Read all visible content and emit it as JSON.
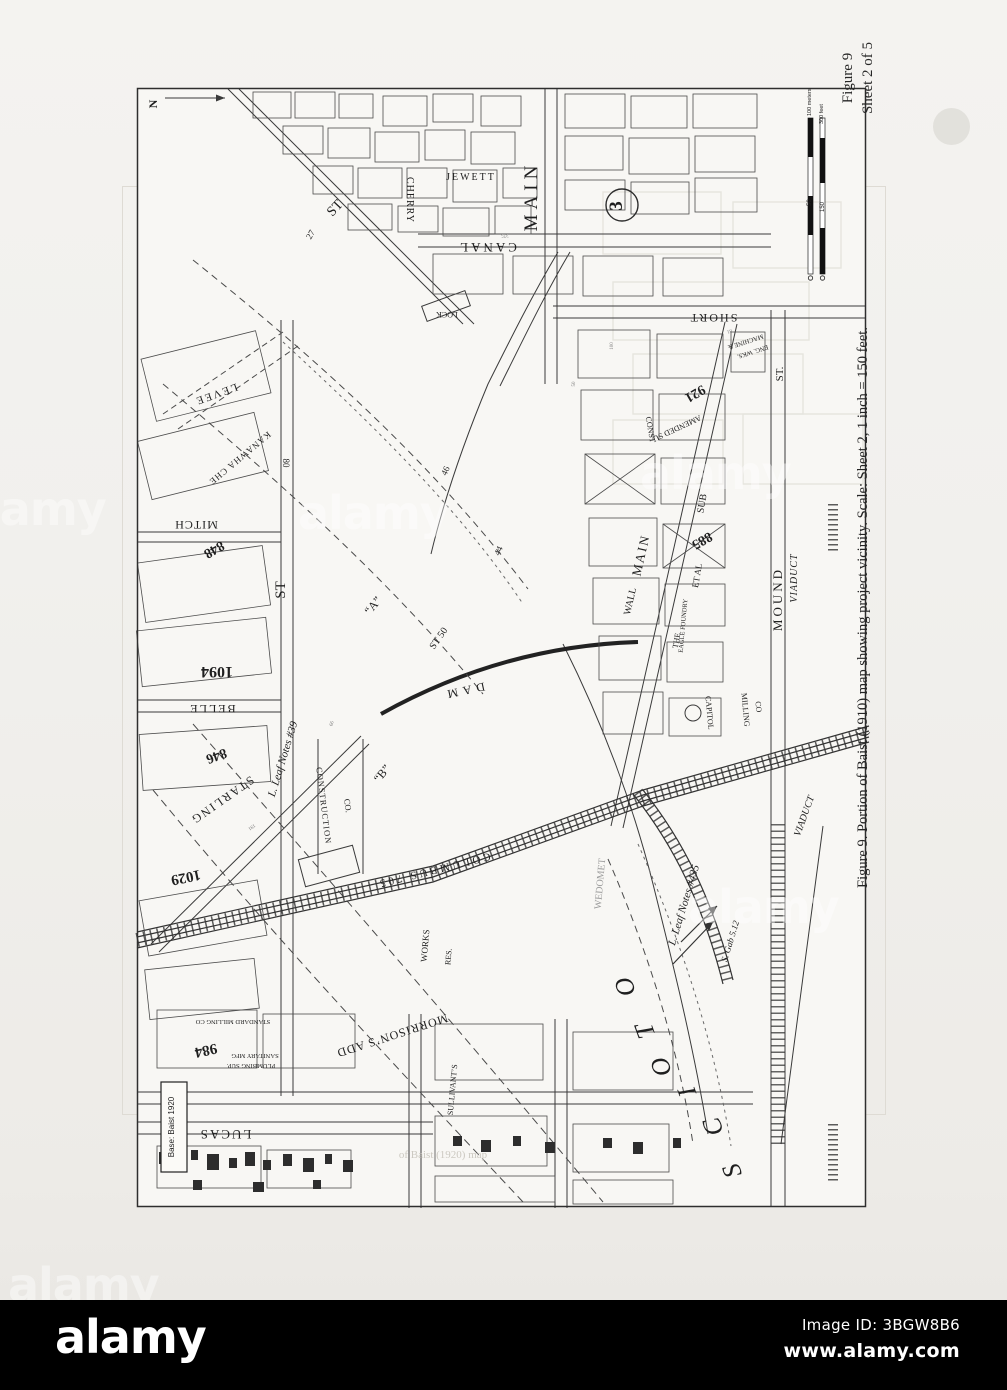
{
  "header": {
    "figure_line1": "Figure 9",
    "figure_line2": "Sheet 2 of 5"
  },
  "caption": "Figure 9.  Portion of Baist (1910) map showing project vicinity.  Scale: Sheet 2, 1 inch = 150 feet.",
  "footer": {
    "brand": "alamy",
    "image_id": "Image ID: 3BGW8B6",
    "url": "www.alamy.com"
  },
  "watermark": {
    "tile": "alamy"
  },
  "map": {
    "labels": [
      {
        "n": "north-label",
        "t": "N",
        "x": 24,
        "y": 20,
        "r": -90,
        "s": 12,
        "w": 1
      },
      {
        "n": "street-st-diagonal",
        "t": "ST",
        "x": 205,
        "y": 127,
        "r": -47,
        "s": 14
      },
      {
        "n": "street-cherry",
        "t": "CHERRY",
        "x": 274,
        "y": 116,
        "r": 90,
        "s": 10,
        "ls": 1
      },
      {
        "n": "street-jewett",
        "t": "JEWETT",
        "x": 338,
        "y": 96,
        "r": 0,
        "s": 10,
        "ls": 2
      },
      {
        "n": "street-main-north",
        "t": "MAIN",
        "x": 404,
        "y": 112,
        "r": -90,
        "s": 19,
        "ls": 5
      },
      {
        "n": "street-canal",
        "t": "CANAL",
        "x": 354,
        "y": 159,
        "r": 180,
        "s": 13,
        "ls": 3
      },
      {
        "n": "lock-label",
        "t": "LOCK",
        "x": 314,
        "y": 228,
        "r": 180,
        "s": 8
      },
      {
        "n": "contour-27",
        "t": "27",
        "x": 180,
        "y": 152,
        "r": -60,
        "s": 9
      },
      {
        "n": "street-short",
        "t": "SHORT",
        "x": 580,
        "y": 230,
        "r": 180,
        "s": 12,
        "ls": 2
      },
      {
        "n": "street-st-right",
        "t": "ST.",
        "x": 650,
        "y": 290,
        "r": -90,
        "s": 11
      },
      {
        "n": "street-mound",
        "t": "MOUND",
        "x": 649,
        "y": 515,
        "r": -90,
        "s": 13,
        "ls": 3
      },
      {
        "n": "mound-viaduct",
        "t": "VIADUCT",
        "x": 664,
        "y": 494,
        "r": -90,
        "s": 10,
        "i": 1,
        "ls": 1
      },
      {
        "n": "machine-works-1",
        "t": "MACHINE &",
        "x": 612,
        "y": 256,
        "r": 162,
        "s": 6.5
      },
      {
        "n": "machine-works-2",
        "t": "ENG. WKS.",
        "x": 619,
        "y": 266,
        "r": 162,
        "s": 6.5
      },
      {
        "n": "plot-921",
        "t": "921",
        "x": 560,
        "y": 306,
        "r": 150,
        "s": 14,
        "w": 1
      },
      {
        "n": "amended-sub",
        "t": "AMENDED SU",
        "x": 543,
        "y": 342,
        "r": 155,
        "s": 8
      },
      {
        "n": "const-label",
        "t": "CONST",
        "x": 515,
        "y": 346,
        "r": 80,
        "s": 8
      },
      {
        "n": "sub-label",
        "t": "SUB",
        "x": 572,
        "y": 420,
        "r": -80,
        "s": 10
      },
      {
        "n": "plot-885",
        "t": "885",
        "x": 567,
        "y": 453,
        "r": 150,
        "s": 14,
        "w": 1
      },
      {
        "n": "et-al",
        "t": "ET AL",
        "x": 567,
        "y": 492,
        "r": -80,
        "s": 9
      },
      {
        "n": "eagle-foundry",
        "t": "EAGLE FOUNDRY",
        "x": 552,
        "y": 542,
        "r": -85,
        "s": 6.5
      },
      {
        "n": "street-main-south",
        "t": "MAIN",
        "x": 512,
        "y": 472,
        "r": -77,
        "s": 13,
        "ls": 2
      },
      {
        "n": "street-wall",
        "t": "WALL",
        "x": 500,
        "y": 518,
        "r": -77,
        "s": 10
      },
      {
        "n": "the-label",
        "t": "THE",
        "x": 546,
        "y": 557,
        "r": -80,
        "s": 8
      },
      {
        "n": "capitol-label",
        "t": "CAPITOL",
        "x": 574,
        "y": 629,
        "r": 85,
        "s": 8
      },
      {
        "n": "milling-label",
        "t": "MILLING",
        "x": 610,
        "y": 626,
        "r": 85,
        "s": 8
      },
      {
        "n": "co-label",
        "t": "CO",
        "x": 623,
        "y": 623,
        "r": 85,
        "s": 8
      },
      {
        "n": "dam-label",
        "t": "DAM",
        "x": 330,
        "y": 603,
        "r": 168,
        "s": 12,
        "ls": 5
      },
      {
        "n": "st50-label",
        "t": "ST 50",
        "x": 308,
        "y": 556,
        "r": -55,
        "s": 10
      },
      {
        "n": "area-a",
        "t": "“A”",
        "x": 243,
        "y": 524,
        "r": -50,
        "s": 12
      },
      {
        "n": "area-b",
        "t": "“B”",
        "x": 252,
        "y": 692,
        "r": -50,
        "s": 12
      },
      {
        "n": "contour-46",
        "t": "46",
        "x": 315,
        "y": 388,
        "r": -65,
        "s": 9
      },
      {
        "n": "contour-44",
        "t": "44",
        "x": 368,
        "y": 468,
        "r": -65,
        "s": 9
      },
      {
        "n": "leaf-notes-39",
        "t": "L. Leaf Notes #39",
        "x": 153,
        "y": 676,
        "r": -73,
        "s": 11,
        "i": 1
      },
      {
        "n": "construction-label",
        "t": "CONSTRUCTION",
        "x": 188,
        "y": 722,
        "r": 83,
        "s": 8.5,
        "ls": 1
      },
      {
        "n": "construction-co",
        "t": "CO.",
        "x": 212,
        "y": 722,
        "r": 83,
        "s": 8.5
      },
      {
        "n": "street-starling",
        "t": "STARLING",
        "x": 87,
        "y": 713,
        "r": 145,
        "s": 12,
        "ls": 2
      },
      {
        "n": "plot-848",
        "t": "848",
        "x": 79,
        "y": 462,
        "r": 150,
        "s": 14,
        "w": 1
      },
      {
        "n": "street-mitch",
        "t": "MITCH",
        "x": 63,
        "y": 437,
        "r": 180,
        "s": 12,
        "ls": 1
      },
      {
        "n": "kanawha-label",
        "t": "KANAWHA CHE",
        "x": 105,
        "y": 372,
        "r": 140,
        "s": 9,
        "ls": 1
      },
      {
        "n": "levee-label",
        "t": "LEVEE",
        "x": 82,
        "y": 307,
        "r": 160,
        "s": 11,
        "ls": 2
      },
      {
        "n": "num-80",
        "t": "80",
        "x": 150,
        "y": 379,
        "r": 90,
        "s": 9
      },
      {
        "n": "street-st-left",
        "t": "ST",
        "x": 152,
        "y": 506,
        "r": -90,
        "s": 15
      },
      {
        "n": "plot-1094",
        "t": "1094",
        "x": 84,
        "y": 583,
        "r": 180,
        "s": 16,
        "w": 1
      },
      {
        "n": "street-belle",
        "t": "BELLE",
        "x": 79,
        "y": 621,
        "r": 180,
        "s": 12,
        "ls": 2
      },
      {
        "n": "plot-846",
        "t": "846",
        "x": 82,
        "y": 668,
        "r": 160,
        "s": 14,
        "w": 1
      },
      {
        "n": "plot-1029",
        "t": "1029",
        "x": 52,
        "y": 789,
        "r": 168,
        "s": 15,
        "w": 1
      },
      {
        "n": "plot-984",
        "t": "984",
        "x": 72,
        "y": 962,
        "r": 168,
        "s": 15,
        "w": 1
      },
      {
        "n": "sanitary-mfg",
        "t": "SANITARY MFG",
        "x": 122,
        "y": 970,
        "r": 180,
        "s": 6.5
      },
      {
        "n": "plumbing-sup",
        "t": "PLUMBING SUP.",
        "x": 118,
        "y": 980,
        "r": 180,
        "s": 6.5
      },
      {
        "n": "standard-milling",
        "t": "STANDARD MILLING CO",
        "x": 100,
        "y": 936,
        "r": 180,
        "s": 6.5
      },
      {
        "n": "street-lucas",
        "t": "LUCAS",
        "x": 92,
        "y": 1046,
        "r": 180,
        "s": 13,
        "ls": 2
      },
      {
        "n": "morrisons-add",
        "t": "MORRISON’S ADD",
        "x": 258,
        "y": 948,
        "r": 162,
        "s": 12,
        "ls": 1
      },
      {
        "n": "sullivants-label",
        "t": "SULLIVANT’S",
        "x": 322,
        "y": 1006,
        "r": -85,
        "s": 8
      },
      {
        "n": "works-label",
        "t": "WORKS",
        "x": 295,
        "y": 862,
        "r": -85,
        "s": 9
      },
      {
        "n": "res-label",
        "t": "RES.",
        "x": 318,
        "y": 873,
        "r": -85,
        "s": 8
      },
      {
        "n": "columbus-705",
        "t": "COLUMBUS 705",
        "x": 300,
        "y": 783,
        "r": 166,
        "s": 11,
        "ls": 3
      },
      {
        "n": "wedomet-label",
        "t": "WEDOMET",
        "x": 470,
        "y": 800,
        "r": -85,
        "s": 10,
        "c": "#9d9d9d"
      },
      {
        "n": "leaf-notes-435",
        "t": "L. Leaf Notes #435",
        "x": 554,
        "y": 822,
        "r": -73,
        "s": 11,
        "i": 1
      },
      {
        "n": "s-gab-512",
        "t": "S. Gab 5.12",
        "x": 600,
        "y": 858,
        "r": -73,
        "s": 9,
        "i": 1
      },
      {
        "n": "scioto-letter-1",
        "t": "S",
        "x": 607,
        "y": 1084,
        "r": -110,
        "s": 26,
        "i": 1
      },
      {
        "n": "scioto-letter-2",
        "t": "C",
        "x": 588,
        "y": 1040,
        "r": -110,
        "s": 26,
        "i": 1
      },
      {
        "n": "scioto-letter-3",
        "t": "I",
        "x": 562,
        "y": 1005,
        "r": -110,
        "s": 26,
        "i": 1
      },
      {
        "n": "scioto-letter-4",
        "t": "O",
        "x": 536,
        "y": 980,
        "r": -110,
        "s": 26,
        "i": 1
      },
      {
        "n": "scioto-letter-5",
        "t": "T",
        "x": 520,
        "y": 944,
        "r": -110,
        "s": 26,
        "i": 1
      },
      {
        "n": "scioto-letter-6",
        "t": "O",
        "x": 500,
        "y": 900,
        "r": -110,
        "s": 26,
        "i": 1
      },
      {
        "n": "viaduct-south",
        "t": "VIADUCT",
        "x": 674,
        "y": 733,
        "r": -70,
        "s": 10,
        "i": 1
      },
      {
        "n": "marker-3",
        "t": "3",
        "x": 489,
        "y": 122,
        "r": -90,
        "s": 19,
        "w": 1
      },
      {
        "n": "base-note",
        "t": "Base: Baist 1920",
        "x": 41,
        "y": 1043,
        "r": -90,
        "s": 8,
        "f": "sans"
      },
      {
        "n": "scale-meters",
        "t": "100 meters",
        "x": 678,
        "y": 32,
        "r": -90,
        "s": 5.5,
        "a": "start",
        "f": "sans"
      },
      {
        "n": "scale-feet",
        "t": "300 feet",
        "x": 690,
        "y": 40,
        "r": -90,
        "s": 5.5,
        "a": "start",
        "f": "sans"
      },
      {
        "n": "scale-50",
        "t": "50",
        "x": 678,
        "y": 122,
        "r": -90,
        "s": 6,
        "a": "start",
        "f": "sans"
      },
      {
        "n": "scale-150",
        "t": "150",
        "x": 691,
        "y": 128,
        "r": -90,
        "s": 6,
        "a": "start",
        "f": "sans"
      },
      {
        "n": "lot-375",
        "t": "375",
        "x": 372,
        "y": 150,
        "r": 180,
        "s": 5,
        "c": "#777777"
      },
      {
        "n": "lot-100",
        "t": "100",
        "x": 480,
        "y": 262,
        "r": -90,
        "s": 5,
        "c": "#777777"
      },
      {
        "n": "lot-50",
        "t": "50",
        "x": 442,
        "y": 300,
        "r": -90,
        "s": 5,
        "c": "#777777"
      },
      {
        "n": "lot-81",
        "t": "81",
        "x": 596,
        "y": 246,
        "r": 160,
        "s": 5,
        "c": "#777777"
      },
      {
        "n": "lot-191",
        "t": "191",
        "x": 118,
        "y": 742,
        "r": 145,
        "s": 5,
        "c": "#777777"
      },
      {
        "n": "lot-66",
        "t": "66",
        "x": 200,
        "y": 640,
        "r": -73,
        "s": 5,
        "c": "#777777"
      },
      {
        "n": "ghost-caption",
        "t": "of Baist (1920) map",
        "x": 310,
        "y": 1074,
        "r": 0,
        "s": 11,
        "c": "#ccc9c1"
      }
    ]
  }
}
